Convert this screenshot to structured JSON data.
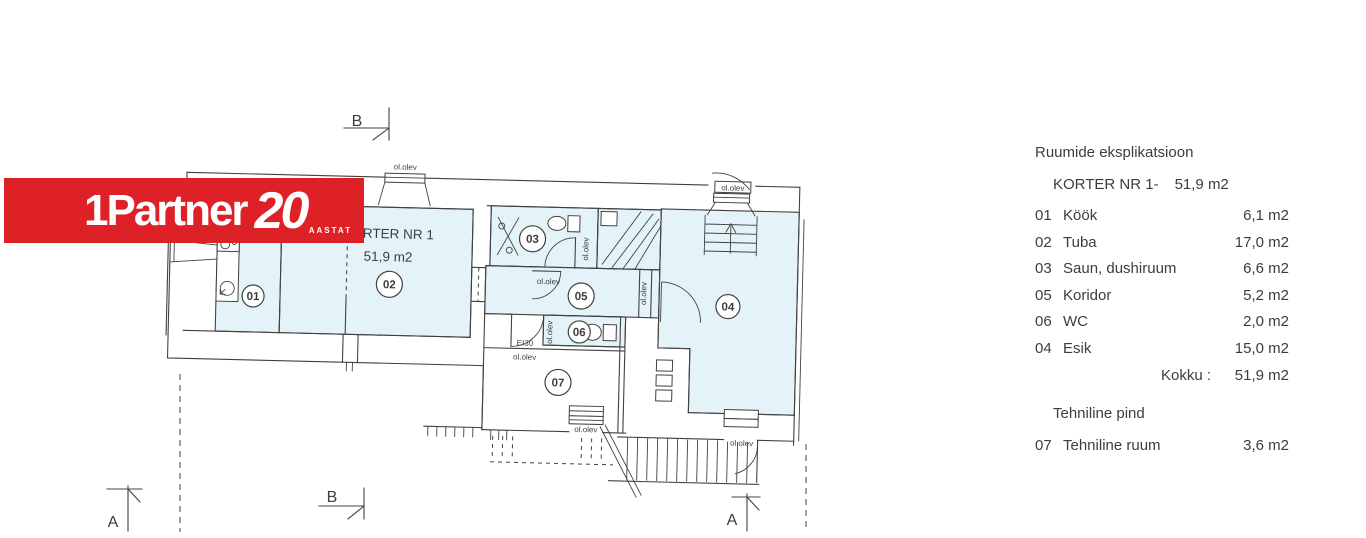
{
  "logo": {
    "brand": "1Partner",
    "anniversary_number": "20",
    "anniversary_label": "AASTAT"
  },
  "legend": {
    "title": "Ruumide eksplikatsioon",
    "subtitle_label": "KORTER NR 1-",
    "subtitle_area": "51,9 m2",
    "rows": [
      {
        "num": "01",
        "name": "Köök",
        "area": "6,1 m2"
      },
      {
        "num": "02",
        "name": "Tuba",
        "area": "17,0 m2"
      },
      {
        "num": "03",
        "name": "Saun, dushiruum",
        "area": "6,6 m2"
      },
      {
        "num": "05",
        "name": "Koridor",
        "area": "5,2 m2"
      },
      {
        "num": "06",
        "name": "WC",
        "area": "2,0 m2"
      },
      {
        "num": "04",
        "name": "Esik",
        "area": "15,0 m2"
      }
    ],
    "total_label": "Kokku :",
    "total_value": "51,9 m2",
    "section2_title": "Tehniline pind",
    "section2_rows": [
      {
        "num": "07",
        "name": "Tehniline ruum",
        "area": "3,6 m2"
      }
    ]
  },
  "plan": {
    "apartment_label": "KORTER NR 1",
    "apartment_area": "51,9 m2",
    "existing_label": "ol.olev",
    "fire_rating_label": "EI30",
    "room_labels": {
      "r01": "01",
      "r02": "02",
      "r03": "03",
      "r04": "04",
      "r05": "05",
      "r06": "06",
      "r07": "07"
    },
    "section_markers": {
      "a": "A",
      "b": "B"
    }
  },
  "colors": {
    "logo_red": "#de2127",
    "room_fill": "#e4f3f8",
    "line": "#414141",
    "text": "#3d3d3d"
  }
}
